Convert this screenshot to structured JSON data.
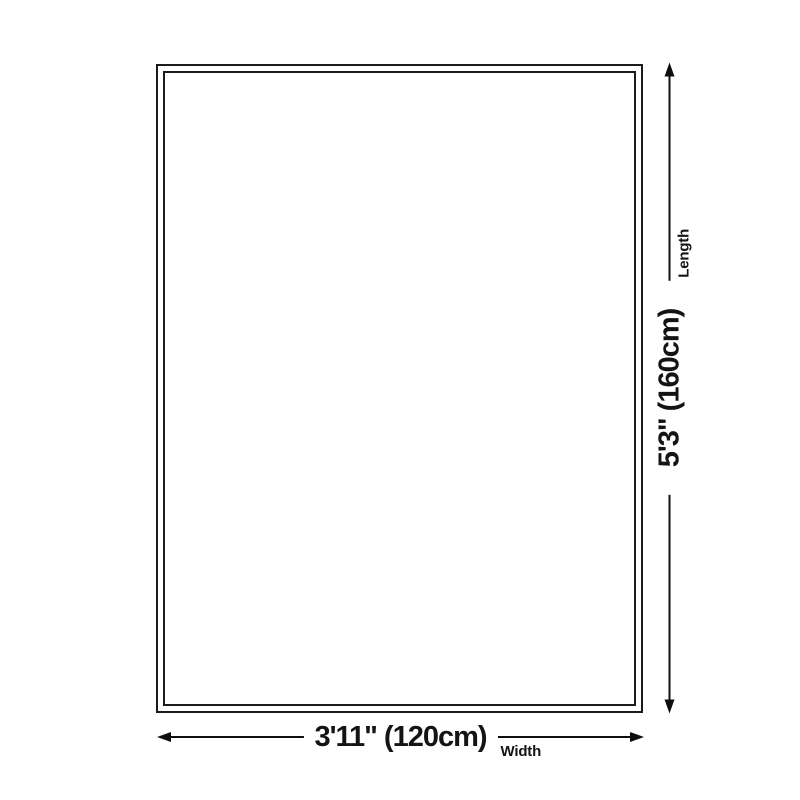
{
  "diagram": {
    "type": "product-dimensions",
    "background_color": "#ffffff",
    "outline_color": "#1b1b1b",
    "arrow_color": "#0f0f0f",
    "text_color": "#141414",
    "rug": {
      "shape": "rectangle-double-border"
    },
    "length": {
      "value": "5'3\" (160cm)",
      "label": "Length"
    },
    "width": {
      "value": "3'11\" (120cm)",
      "label": "Width"
    }
  }
}
